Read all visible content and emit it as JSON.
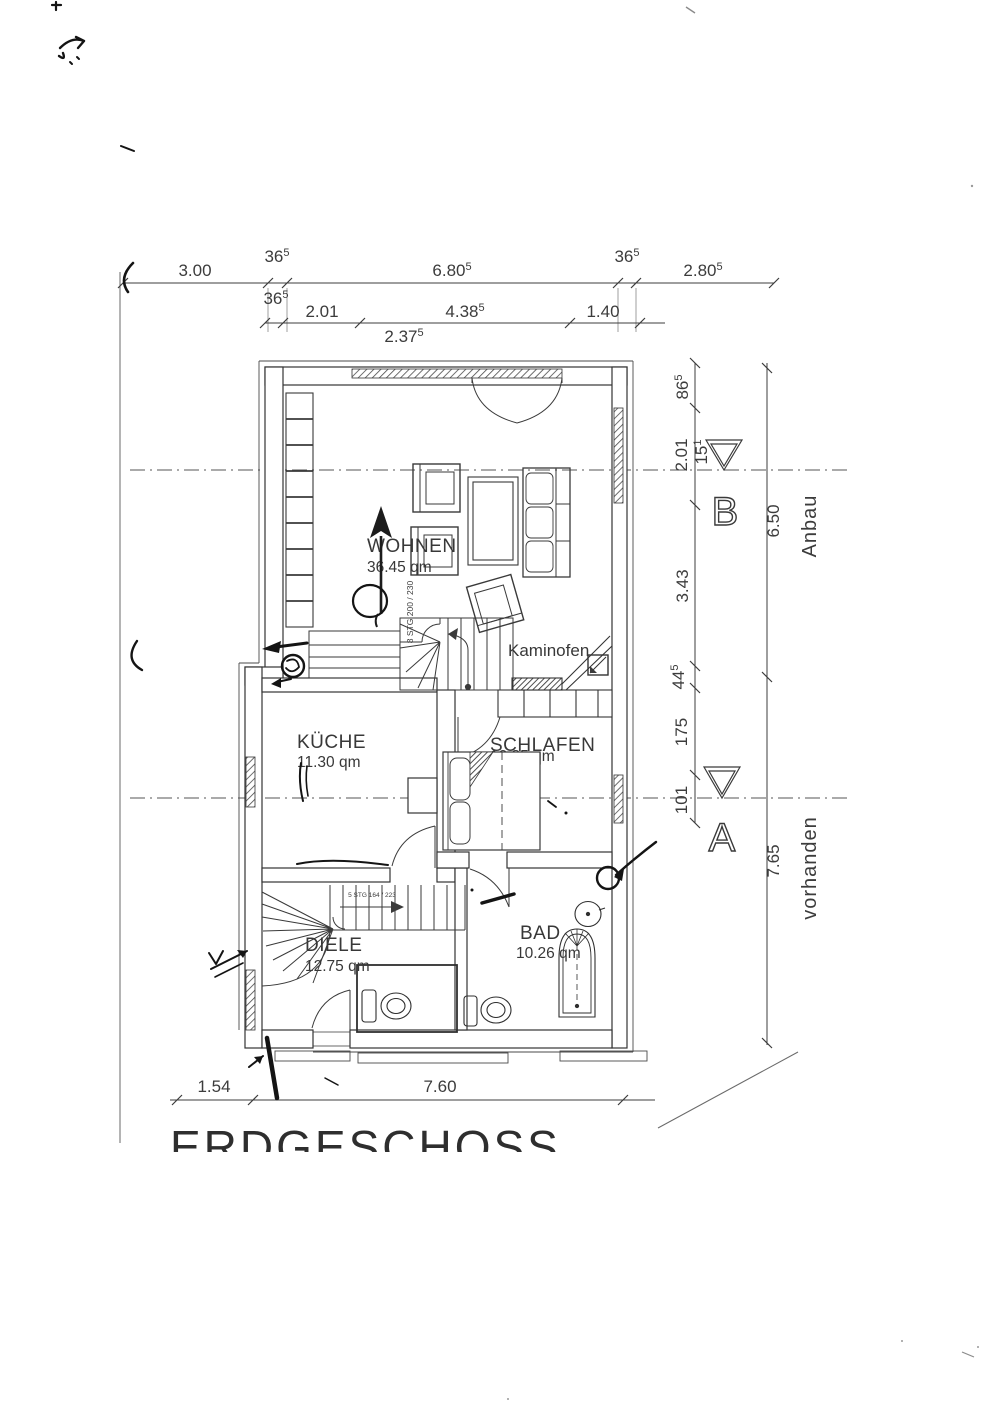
{
  "labels": {
    "title": "ERDGESCHOSS",
    "kaminofen": "Kaminofen",
    "anbau": "Anbau",
    "vorhanden": "vorhanden",
    "section_a": "A",
    "section_b": "B"
  },
  "rooms": {
    "wohnen": {
      "name": "WOHNEN",
      "area": "36.45 qm"
    },
    "kueche": {
      "name": "KÜCHE",
      "area": "11.30 qm"
    },
    "schlafen": {
      "name": "SCHLAFEN",
      "area": "12.85 qm"
    },
    "diele": {
      "name": "DIELE",
      "area": "12.75 qm"
    },
    "bad": {
      "name": "BAD",
      "area": "10.26 qm"
    }
  },
  "stairs": {
    "main": "8 STG 200 / 230",
    "hall": "5 STG 164 / 223"
  },
  "dims": {
    "top1": {
      "v1": "3.00",
      "v2_m": "36",
      "v2_s": "5",
      "v3_m": "6.80",
      "v3_s": "5",
      "v4_m": "36",
      "v4_s": "5",
      "v5_m": "2.80",
      "v5_s": "5"
    },
    "top2": {
      "v1_m": "36",
      "v1_s": "5",
      "v2": "2.01",
      "v3_m": "4.38",
      "v3_s": "5",
      "v4": "1.40",
      "v5_m": "2.37",
      "v5_s": "5"
    },
    "right_inner": {
      "v1_m": "86",
      "v1_s": "5",
      "v2": "2.01",
      "v3_m": "15",
      "v3_s": "1",
      "v4": "3.43",
      "v5_m": "44",
      "v5_s": "5",
      "v6": "175",
      "v7": "101"
    },
    "right_outer": {
      "v1": "6.50",
      "v2": "7.65"
    },
    "bottom": {
      "v1": "1.54",
      "v2": "7.60"
    }
  },
  "colors": {
    "ink": "#3c3c3c",
    "pen": "#141414",
    "paper": "#ffffff"
  }
}
